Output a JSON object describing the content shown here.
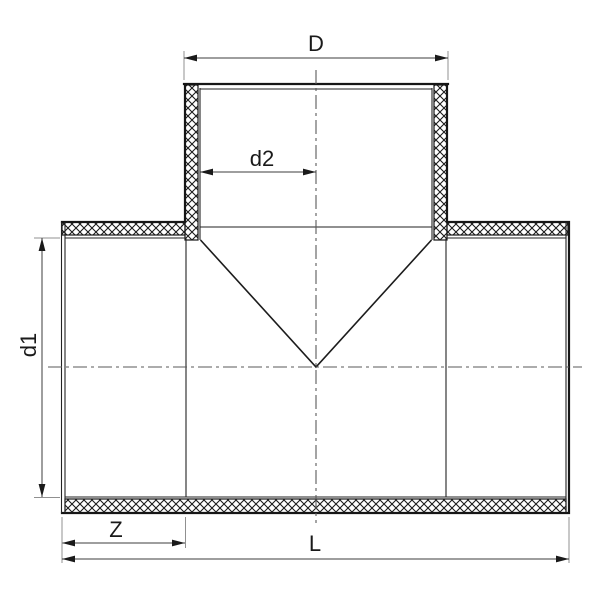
{
  "drawing": {
    "kind_visible": "pipe tee fitting cross-section",
    "colors": {
      "background": "#ffffff",
      "object_line": "#161616",
      "dimension_line": "#3d3d3d",
      "extension_line": "#909090",
      "centerline": "#5a5a5a"
    },
    "dimensions": {
      "top_width_label": "D",
      "branch_inner_label": "d2",
      "left_inner_label": "d1",
      "socket_depth_label": "Z",
      "total_length_label": "L"
    }
  }
}
